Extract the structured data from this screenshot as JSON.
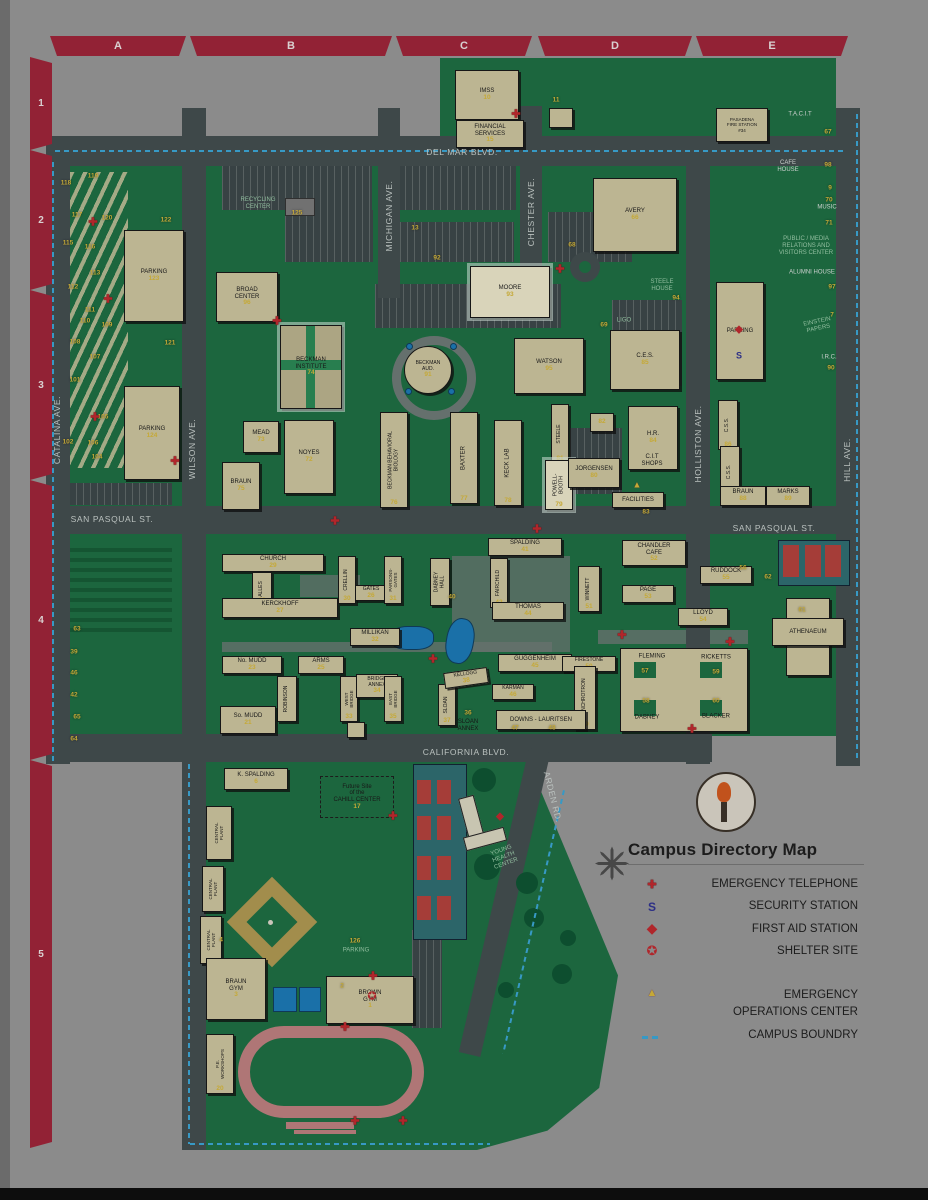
{
  "map_title": "Campus Directory Map",
  "grid": {
    "cols": [
      "A",
      "B",
      "C",
      "D",
      "E"
    ],
    "rows": [
      "1",
      "2",
      "3",
      "4",
      "5"
    ]
  },
  "colors": {
    "grid_band": "#a02338",
    "campus_green": "#1c6f42",
    "road": "#424d4f",
    "building": "#cfc7a0",
    "number_yellow": "#d8b93a",
    "boundary_blue": "#3aa7d8",
    "emergency_red": "#c1272d",
    "security_blue": "#2e3192",
    "highlight_cream": "#efe9cc"
  },
  "legend": {
    "title": "Campus Directory Map",
    "items": [
      {
        "icon": "emergency-telephone",
        "label": "EMERGENCY TELEPHONE"
      },
      {
        "icon": "security-station",
        "label": "SECURITY STATION"
      },
      {
        "icon": "first-aid-station",
        "label": "FIRST AID STATION"
      },
      {
        "icon": "shelter-site",
        "label": "SHELTER SITE"
      },
      {
        "icon": "emergency-operations-center",
        "label": "EMERGENCY\nOPERATIONS CENTER"
      },
      {
        "icon": "campus-boundary",
        "label": "CAMPUS BOUNDRY"
      }
    ]
  },
  "streets": [
    {
      "t": "DEL MAR BLVD.",
      "x": 462,
      "y": 152,
      "r": 0
    },
    {
      "t": "SAN PASQUAL ST.",
      "x": 112,
      "y": 519,
      "r": 0
    },
    {
      "t": "SAN PASQUAL ST.",
      "x": 774,
      "y": 528,
      "r": 0
    },
    {
      "t": "CALIFORNIA BLVD.",
      "x": 466,
      "y": 752,
      "r": 0
    },
    {
      "t": "CATALINA AVE.",
      "x": 57,
      "y": 430,
      "r": -90
    },
    {
      "t": "WILSON AVE.",
      "x": 192,
      "y": 449,
      "r": -90
    },
    {
      "t": "MICHIGAN AVE.",
      "x": 389,
      "y": 216,
      "r": -90
    },
    {
      "t": "CHESTER AVE.",
      "x": 531,
      "y": 212,
      "r": -90
    },
    {
      "t": "HOLLISTON AVE.",
      "x": 698,
      "y": 444,
      "r": -90
    },
    {
      "t": "HILL AVE.",
      "x": 847,
      "y": 460,
      "r": -90
    },
    {
      "t": "ARDEN RD.",
      "x": 553,
      "y": 797,
      "r": 76
    }
  ],
  "buildings": [
    {
      "k": "b",
      "t": "IMSS",
      "n": "10",
      "x": 455,
      "y": 70,
      "w": 62,
      "h": 48
    },
    {
      "k": "b",
      "t": "FINANCIAL\nSERVICES",
      "n": "15",
      "x": 456,
      "y": 120,
      "w": 66,
      "h": 26
    },
    {
      "k": "b",
      "t": "",
      "n": "",
      "x": 549,
      "y": 108,
      "w": 22,
      "h": 18
    },
    {
      "k": "b",
      "t": "PASADENA\nFIRE STATION\n#34",
      "n": "",
      "x": 716,
      "y": 108,
      "w": 50,
      "h": 32,
      "fs": 4.5
    },
    {
      "k": "b",
      "t": "AVERY",
      "n": "66",
      "x": 593,
      "y": 178,
      "w": 82,
      "h": 72
    },
    {
      "k": "b",
      "t": "PARKING",
      "n": "",
      "x": 716,
      "y": 282,
      "w": 46,
      "h": 96
    },
    {
      "k": "b",
      "t": "BROAD\nCENTER",
      "n": "96",
      "x": 216,
      "y": 272,
      "w": 60,
      "h": 48
    },
    {
      "k": "hl bi",
      "t": "BECKMAN\nINSTITUTE",
      "n": "74",
      "x": 280,
      "y": 325,
      "w": 60,
      "h": 82
    },
    {
      "k": "round",
      "t": "BECKMAN\nAUD.",
      "n": "91",
      "x": 404,
      "y": 346,
      "w": 46,
      "h": 46,
      "fs": 5
    },
    {
      "k": "hl",
      "t": "MOORE",
      "n": "93",
      "x": 470,
      "y": 266,
      "w": 78,
      "h": 50
    },
    {
      "k": "b",
      "t": "C.E.S.",
      "n": "85",
      "x": 610,
      "y": 330,
      "w": 68,
      "h": 58
    },
    {
      "k": "b",
      "t": "WATSON",
      "n": "95",
      "x": 514,
      "y": 338,
      "w": 68,
      "h": 54
    },
    {
      "k": "b",
      "t": "H.R.",
      "n": "84",
      "x": 628,
      "y": 406,
      "w": 48,
      "h": 62
    },
    {
      "k": "b",
      "t": "FACILITIES",
      "n": "",
      "x": 612,
      "y": 492,
      "w": 50,
      "h": 14
    },
    {
      "k": "b",
      "t": "MEAD",
      "n": "73",
      "x": 243,
      "y": 421,
      "w": 34,
      "h": 30
    },
    {
      "k": "b",
      "t": "NOYES",
      "n": "72",
      "x": 284,
      "y": 420,
      "w": 48,
      "h": 72
    },
    {
      "k": "b",
      "t": "BRAUN",
      "n": "75",
      "x": 222,
      "y": 462,
      "w": 36,
      "h": 46
    },
    {
      "k": "bv",
      "t": "BECKMAN BEHAVIORAL\nBIOLOGY",
      "n": "76",
      "x": 380,
      "y": 412,
      "w": 26,
      "h": 94,
      "fs": 5
    },
    {
      "k": "bv",
      "t": "BAXTER",
      "n": "77",
      "x": 450,
      "y": 412,
      "w": 26,
      "h": 90
    },
    {
      "k": "bv",
      "t": "KECK LAB",
      "n": "78",
      "x": 494,
      "y": 420,
      "w": 26,
      "h": 84
    },
    {
      "k": "bv",
      "t": "STEELE",
      "n": "81",
      "x": 551,
      "y": 404,
      "w": 16,
      "h": 58,
      "fs": 5
    },
    {
      "k": "b",
      "t": "",
      "n": "82",
      "x": 590,
      "y": 413,
      "w": 22,
      "h": 17
    },
    {
      "k": "bv hl",
      "t": "POWELL-\nBOOTH",
      "n": "79",
      "x": 545,
      "y": 460,
      "w": 26,
      "h": 48,
      "fs": 5
    },
    {
      "k": "b",
      "t": "JORGENSEN",
      "n": "80",
      "x": 568,
      "y": 458,
      "w": 50,
      "h": 28
    },
    {
      "k": "bv",
      "t": "C.S.S.",
      "n": "86",
      "x": 718,
      "y": 400,
      "w": 18,
      "h": 48,
      "fs": 5
    },
    {
      "k": "bv",
      "t": "C.S.S.",
      "n": "87",
      "x": 720,
      "y": 446,
      "w": 18,
      "h": 50,
      "fs": 5
    },
    {
      "k": "b",
      "t": "BRAUN",
      "n": "88",
      "x": 720,
      "y": 486,
      "w": 44,
      "h": 18
    },
    {
      "k": "b",
      "t": "MARKS",
      "n": "89",
      "x": 766,
      "y": 486,
      "w": 42,
      "h": 18
    },
    {
      "k": "b",
      "t": "PARKING",
      "n": "123",
      "x": 124,
      "y": 230,
      "w": 58,
      "h": 90
    },
    {
      "k": "b",
      "t": "PARKING",
      "n": "124",
      "x": 124,
      "y": 386,
      "w": 54,
      "h": 92
    },
    {
      "k": "b",
      "t": "CHURCH",
      "n": "29",
      "x": 222,
      "y": 554,
      "w": 100,
      "h": 16
    },
    {
      "k": "bv",
      "t": "ALLES",
      "n": "28",
      "x": 252,
      "y": 572,
      "w": 18,
      "h": 32,
      "fs": 5
    },
    {
      "k": "b",
      "t": "KERCKHOFF",
      "n": "27",
      "x": 222,
      "y": 598,
      "w": 114,
      "h": 18
    },
    {
      "k": "bv",
      "t": "CRELLIN",
      "n": "30",
      "x": 338,
      "y": 556,
      "w": 16,
      "h": 46,
      "fs": 5
    },
    {
      "k": "b",
      "t": "GATES",
      "n": "26",
      "x": 355,
      "y": 585,
      "w": 30,
      "h": 14,
      "fs": 5
    },
    {
      "k": "bv",
      "t": "PARSONS-\nGATES",
      "n": "31",
      "x": 384,
      "y": 556,
      "w": 16,
      "h": 46,
      "fs": 4.5
    },
    {
      "k": "bv",
      "t": "DABNEY\nHALL",
      "n": "",
      "x": 430,
      "y": 558,
      "w": 18,
      "h": 46,
      "fs": 5
    },
    {
      "k": "b",
      "t": "SPALDING",
      "n": "41",
      "x": 488,
      "y": 538,
      "w": 72,
      "h": 16
    },
    {
      "k": "bv",
      "t": "FAIRCHILD",
      "n": "42",
      "x": 490,
      "y": 558,
      "w": 16,
      "h": 48,
      "fs": 5
    },
    {
      "k": "b",
      "t": "THOMAS",
      "n": "44",
      "x": 492,
      "y": 602,
      "w": 70,
      "h": 16
    },
    {
      "k": "b",
      "t": "MILLIKAN",
      "n": "32",
      "x": 350,
      "y": 628,
      "w": 48,
      "h": 16
    },
    {
      "k": "bv",
      "t": "WINNETT",
      "n": "51",
      "x": 578,
      "y": 566,
      "w": 20,
      "h": 44,
      "fs": 5
    },
    {
      "k": "b",
      "t": "CHANDLER\nCAFE",
      "n": "52",
      "x": 622,
      "y": 540,
      "w": 62,
      "h": 24
    },
    {
      "k": "b",
      "t": "RUDDOCK",
      "n": "55",
      "x": 700,
      "y": 566,
      "w": 50,
      "h": 16
    },
    {
      "k": "b",
      "t": "PAGE",
      "n": "53",
      "x": 622,
      "y": 585,
      "w": 50,
      "h": 16
    },
    {
      "k": "b",
      "t": "LLOYD",
      "n": "54",
      "x": 678,
      "y": 608,
      "w": 48,
      "h": 16
    },
    {
      "k": "b",
      "t": "No. MUDD",
      "n": "23",
      "x": 222,
      "y": 656,
      "w": 58,
      "h": 16
    },
    {
      "k": "b",
      "t": "ARMS",
      "n": "25",
      "x": 298,
      "y": 656,
      "w": 44,
      "h": 16
    },
    {
      "k": "bv",
      "t": "ROBINSON",
      "n": "",
      "x": 277,
      "y": 676,
      "w": 18,
      "h": 44,
      "fs": 5
    },
    {
      "k": "b",
      "t": "So. MUDD",
      "n": "21",
      "x": 220,
      "y": 706,
      "w": 54,
      "h": 26
    },
    {
      "k": "bv",
      "t": "WEST\nBRIDGE",
      "n": "33",
      "x": 340,
      "y": 676,
      "w": 16,
      "h": 44,
      "fs": 4.5
    },
    {
      "k": "b",
      "t": "BRIDGE\nANNEX",
      "n": "34",
      "x": 356,
      "y": 674,
      "w": 40,
      "h": 22,
      "fs": 5
    },
    {
      "k": "bv",
      "t": "EAST\nBRIDGE",
      "n": "35",
      "x": 384,
      "y": 676,
      "w": 16,
      "h": 44,
      "fs": 4.5
    },
    {
      "k": "b",
      "t": "",
      "n": "",
      "x": 347,
      "y": 722,
      "w": 16,
      "h": 14
    },
    {
      "k": "bv",
      "t": "SLOAN",
      "n": "37",
      "x": 438,
      "y": 684,
      "w": 16,
      "h": 40,
      "fs": 5
    },
    {
      "k": "b",
      "t": "KELLOGG",
      "n": "38",
      "x": 444,
      "y": 670,
      "w": 42,
      "h": 14,
      "r": -8,
      "fs": 5
    },
    {
      "k": "b",
      "t": "GUGGENHEIM",
      "n": "45",
      "x": 498,
      "y": 654,
      "w": 72,
      "h": 16
    },
    {
      "k": "b",
      "t": "FIRESTONE",
      "n": "50",
      "x": 562,
      "y": 656,
      "w": 52,
      "h": 14,
      "fs": 5
    },
    {
      "k": "b",
      "t": "KARMAN",
      "n": "46",
      "x": 492,
      "y": 684,
      "w": 40,
      "h": 14,
      "fs": 5
    },
    {
      "k": "bv",
      "t": "SYNCHROTRON",
      "n": "49",
      "x": 574,
      "y": 666,
      "w": 20,
      "h": 62,
      "fs": 5
    },
    {
      "k": "b",
      "t": "DOWNS - LAURITSEN",
      "n": "",
      "x": 496,
      "y": 710,
      "w": 88,
      "h": 18
    },
    {
      "k": "b",
      "t": "",
      "n": "",
      "x": 786,
      "y": 598,
      "w": 42,
      "h": 76
    },
    {
      "k": "b",
      "t": "ATHENAEUM",
      "n": "",
      "x": 772,
      "y": 618,
      "w": 70,
      "h": 26
    },
    {
      "k": "b",
      "t": "K. SPALDING",
      "n": "6",
      "x": 224,
      "y": 768,
      "w": 62,
      "h": 20
    },
    {
      "k": "dash",
      "t": "Future Site\nof the\nCAHILL CENTER",
      "n": "17",
      "x": 320,
      "y": 776,
      "w": 72,
      "h": 40
    },
    {
      "k": "bv",
      "t": "CENTRAL\nPLANT",
      "n": "",
      "x": 206,
      "y": 806,
      "w": 24,
      "h": 52,
      "fs": 4.5
    },
    {
      "k": "bv",
      "t": "CENTRAL\nPLANT",
      "n": "",
      "x": 202,
      "y": 866,
      "w": 20,
      "h": 44,
      "fs": 4.5
    },
    {
      "k": "bv",
      "t": "CENTRAL\nPLANT",
      "n": "",
      "x": 200,
      "y": 916,
      "w": 20,
      "h": 46,
      "fs": 4.5
    },
    {
      "k": "b",
      "t": "BRAUN\nGYM",
      "n": "3",
      "x": 206,
      "y": 958,
      "w": 58,
      "h": 60
    },
    {
      "k": "b",
      "t": "BROWN\nGYM",
      "n": "1",
      "x": 326,
      "y": 976,
      "w": 86,
      "h": 46
    },
    {
      "k": "bv",
      "t": "P.E.\nWORKSHOPS",
      "n": "20",
      "x": 206,
      "y": 1034,
      "w": 26,
      "h": 58,
      "fs": 4.5
    }
  ],
  "labels": [
    {
      "t": "RECYCLING\nCENTER",
      "x": 258,
      "y": 204,
      "c": "lg"
    },
    {
      "t": "T.A.C.I.T",
      "x": 800,
      "y": 115,
      "c": "w"
    },
    {
      "t": "CAFE\nHOUSE",
      "x": 788,
      "y": 167,
      "c": "w"
    },
    {
      "t": "MUSIC",
      "x": 827,
      "y": 208,
      "c": "w"
    },
    {
      "t": "PUBLIC / MEDIA\nRELATIONS AND\nVISITORS CENTER",
      "x": 806,
      "y": 247,
      "c": "lg"
    },
    {
      "t": "ALUMNI HOUSE",
      "x": 812,
      "y": 273,
      "c": "w"
    },
    {
      "t": "EINSTEIN\nPAPERS",
      "x": 818,
      "y": 326,
      "c": "lg",
      "r": -12
    },
    {
      "t": "I.R.C.",
      "x": 829,
      "y": 358,
      "c": "w"
    },
    {
      "t": "STEELE\nHOUSE",
      "x": 662,
      "y": 286,
      "c": "lg"
    },
    {
      "t": "LIGO",
      "x": 624,
      "y": 321,
      "c": "lg"
    },
    {
      "t": "C.I.T\nSHOPS",
      "x": 652,
      "y": 461,
      "c": "k"
    },
    {
      "t": "SLOAN\nANNEX",
      "x": 468,
      "y": 726,
      "c": "k"
    },
    {
      "t": "FLEMING",
      "x": 652,
      "y": 657,
      "c": "k"
    },
    {
      "t": "RICKETTS",
      "x": 716,
      "y": 658,
      "c": "k"
    },
    {
      "t": "DABNEY",
      "x": 647,
      "y": 718,
      "c": "k"
    },
    {
      "t": "BLACKER",
      "x": 716,
      "y": 717,
      "c": "k"
    },
    {
      "t": "YOUNG\nHEALTH\nCENTER",
      "x": 504,
      "y": 858,
      "c": "lg",
      "r": -20
    },
    {
      "t": "PARKING",
      "x": 356,
      "y": 951,
      "c": "lg"
    }
  ],
  "numbers": [
    {
      "n": "11",
      "x": 556,
      "y": 100
    },
    {
      "n": "13",
      "x": 415,
      "y": 228
    },
    {
      "n": "92",
      "x": 437,
      "y": 258
    },
    {
      "n": "68",
      "x": 572,
      "y": 245
    },
    {
      "n": "67",
      "x": 828,
      "y": 132
    },
    {
      "n": "98",
      "x": 828,
      "y": 165
    },
    {
      "n": "9",
      "x": 830,
      "y": 188
    },
    {
      "n": "70",
      "x": 829,
      "y": 200
    },
    {
      "n": "71",
      "x": 829,
      "y": 223
    },
    {
      "n": "97",
      "x": 832,
      "y": 287
    },
    {
      "n": "7",
      "x": 832,
      "y": 315
    },
    {
      "n": "90",
      "x": 831,
      "y": 368
    },
    {
      "n": "94",
      "x": 676,
      "y": 298
    },
    {
      "n": "69",
      "x": 604,
      "y": 325
    },
    {
      "n": "56",
      "x": 743,
      "y": 568
    },
    {
      "n": "62",
      "x": 768,
      "y": 577
    },
    {
      "n": "61",
      "x": 802,
      "y": 610
    },
    {
      "n": "36",
      "x": 468,
      "y": 713
    },
    {
      "n": "40",
      "x": 452,
      "y": 597
    },
    {
      "n": "83",
      "x": 646,
      "y": 512
    },
    {
      "n": "47",
      "x": 515,
      "y": 728
    },
    {
      "n": "48",
      "x": 552,
      "y": 728
    },
    {
      "n": "57",
      "x": 645,
      "y": 671
    },
    {
      "n": "59",
      "x": 716,
      "y": 672
    },
    {
      "n": "58",
      "x": 646,
      "y": 701
    },
    {
      "n": "60",
      "x": 716,
      "y": 701
    },
    {
      "n": "126",
      "x": 355,
      "y": 941
    },
    {
      "n": "2",
      "x": 342,
      "y": 986
    },
    {
      "n": "4",
      "x": 221,
      "y": 940
    },
    {
      "n": "125",
      "x": 297,
      "y": 213
    },
    {
      "n": "119",
      "x": 93,
      "y": 176
    },
    {
      "n": "118",
      "x": 66,
      "y": 183
    },
    {
      "n": "117",
      "x": 77,
      "y": 215
    },
    {
      "n": "120",
      "x": 107,
      "y": 218
    },
    {
      "n": "122",
      "x": 166,
      "y": 220
    },
    {
      "n": "115",
      "x": 68,
      "y": 243
    },
    {
      "n": "116",
      "x": 90,
      "y": 247
    },
    {
      "n": "113",
      "x": 95,
      "y": 273
    },
    {
      "n": "112",
      "x": 73,
      "y": 287
    },
    {
      "n": "111",
      "x": 90,
      "y": 310
    },
    {
      "n": "110",
      "x": 85,
      "y": 321
    },
    {
      "n": "109",
      "x": 107,
      "y": 325
    },
    {
      "n": "121",
      "x": 170,
      "y": 343
    },
    {
      "n": "108",
      "x": 75,
      "y": 342
    },
    {
      "n": "107",
      "x": 95,
      "y": 357
    },
    {
      "n": "101",
      "x": 75,
      "y": 380
    },
    {
      "n": "105",
      "x": 103,
      "y": 417
    },
    {
      "n": "102",
      "x": 68,
      "y": 442
    },
    {
      "n": "106",
      "x": 93,
      "y": 443
    },
    {
      "n": "104",
      "x": 97,
      "y": 457
    },
    {
      "n": "63",
      "x": 77,
      "y": 629
    },
    {
      "n": "39",
      "x": 74,
      "y": 652
    },
    {
      "n": "46",
      "x": 74,
      "y": 673
    },
    {
      "n": "42",
      "x": 74,
      "y": 695
    },
    {
      "n": "65",
      "x": 77,
      "y": 717
    },
    {
      "n": "64",
      "x": 74,
      "y": 739
    }
  ],
  "markers": [
    {
      "t": "cross",
      "x": 516,
      "y": 115
    },
    {
      "t": "cross",
      "x": 277,
      "y": 322
    },
    {
      "t": "cross",
      "x": 560,
      "y": 270
    },
    {
      "t": "cross",
      "x": 335,
      "y": 522
    },
    {
      "t": "cross",
      "x": 537,
      "y": 530
    },
    {
      "t": "cross",
      "x": 433,
      "y": 660
    },
    {
      "t": "cross",
      "x": 622,
      "y": 636
    },
    {
      "t": "cross",
      "x": 730,
      "y": 643
    },
    {
      "t": "cross",
      "x": 692,
      "y": 730
    },
    {
      "t": "cross",
      "x": 393,
      "y": 817
    },
    {
      "t": "cross",
      "x": 373,
      "y": 977
    },
    {
      "t": "cross",
      "x": 345,
      "y": 1028
    },
    {
      "t": "cross",
      "x": 355,
      "y": 1122
    },
    {
      "t": "cross",
      "x": 403,
      "y": 1122
    },
    {
      "t": "cross",
      "x": 93,
      "y": 223
    },
    {
      "t": "cross",
      "x": 108,
      "y": 300
    },
    {
      "t": "cross",
      "x": 95,
      "y": 418
    },
    {
      "t": "cross",
      "x": 175,
      "y": 462
    },
    {
      "t": "aid",
      "x": 739,
      "y": 330
    },
    {
      "t": "aid",
      "x": 500,
      "y": 817
    },
    {
      "t": "sec",
      "x": 739,
      "y": 356
    },
    {
      "t": "shelter",
      "x": 372,
      "y": 997
    },
    {
      "t": "eoc",
      "x": 637,
      "y": 485
    }
  ]
}
